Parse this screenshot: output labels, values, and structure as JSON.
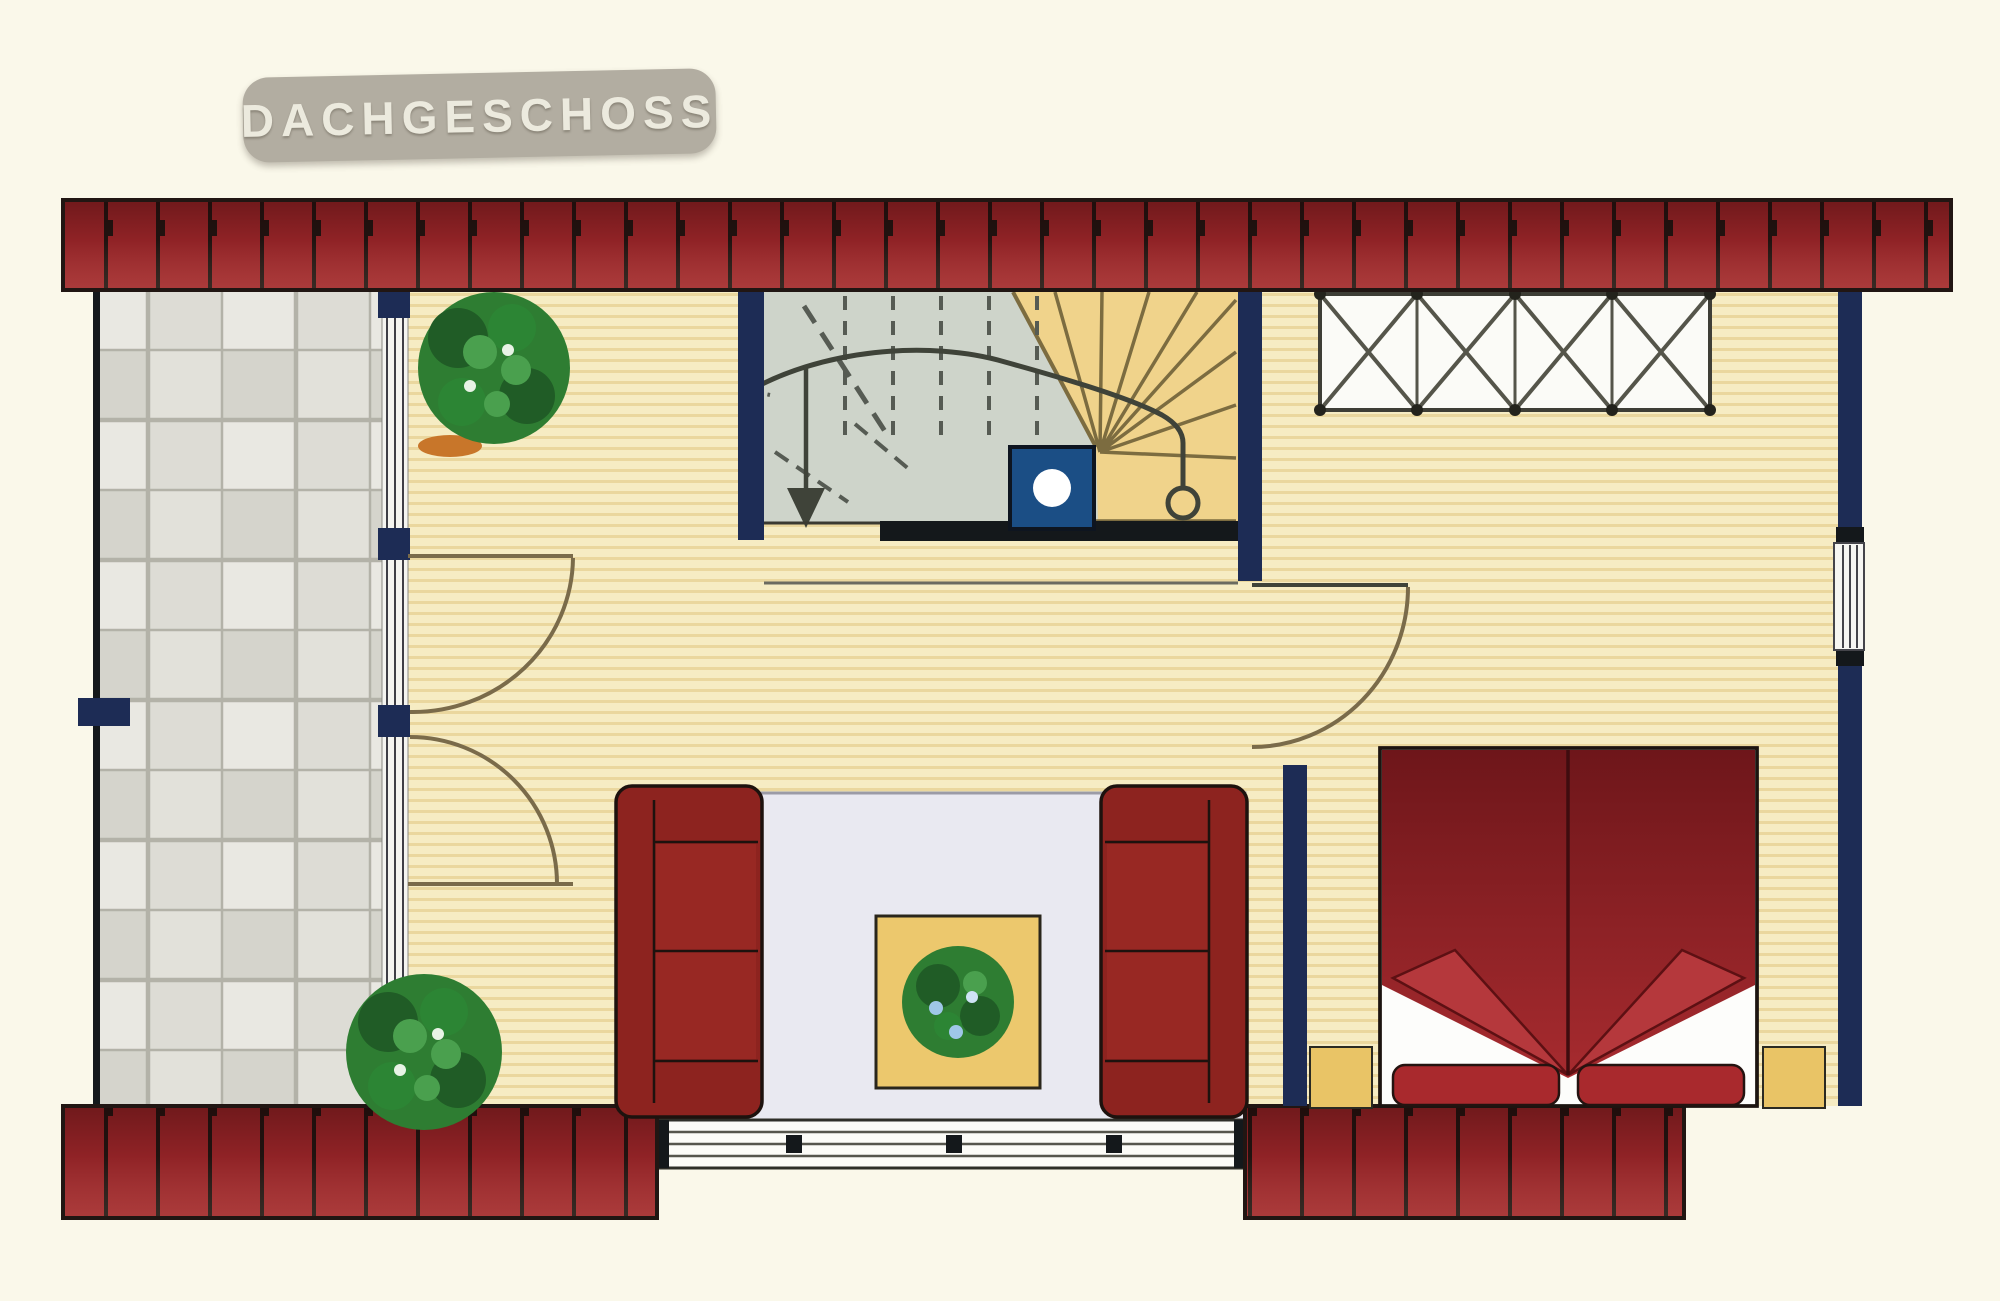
{
  "title": {
    "label": "DACHGESCHOSS"
  },
  "palette": {
    "bg": "#faf8ea",
    "badge_bg": "#b2ada1",
    "badge_text": "#eceade",
    "roof_red": "#a2282c",
    "roof_line": "#211613",
    "navy": "#1d2c55",
    "black_wall": "#14181b",
    "stair_gray": "#ced4ca",
    "winder_tan": "#f0d38b",
    "stair_line": "#7c6c40",
    "tread_dash": "#565b53",
    "marker_blue": "#1b4e85",
    "wood_light": "#f6ecc3",
    "wood_dark": "#ead79e",
    "tile_line": "#b3b2a8",
    "rug": "#e9e9f1",
    "rug_edge": "#9b9ba6",
    "sofa_red": "#8d231f",
    "sofa_line": "#1d120e",
    "bed_dark": "#6e161a",
    "bed_red": "#a72b2f",
    "fold_red": "#b5383c",
    "pillow_red": "#a9292d",
    "table_yellow": "#ecc86d",
    "nightstand_yellow": "#e9c466",
    "plant_dark": "#205c26",
    "plant_green": "#2e7d32",
    "plant_light": "#4aa04e",
    "panel_white": "#fbfbf7",
    "line_dark": "#3f4339",
    "door_line": "#7a6b4a"
  }
}
